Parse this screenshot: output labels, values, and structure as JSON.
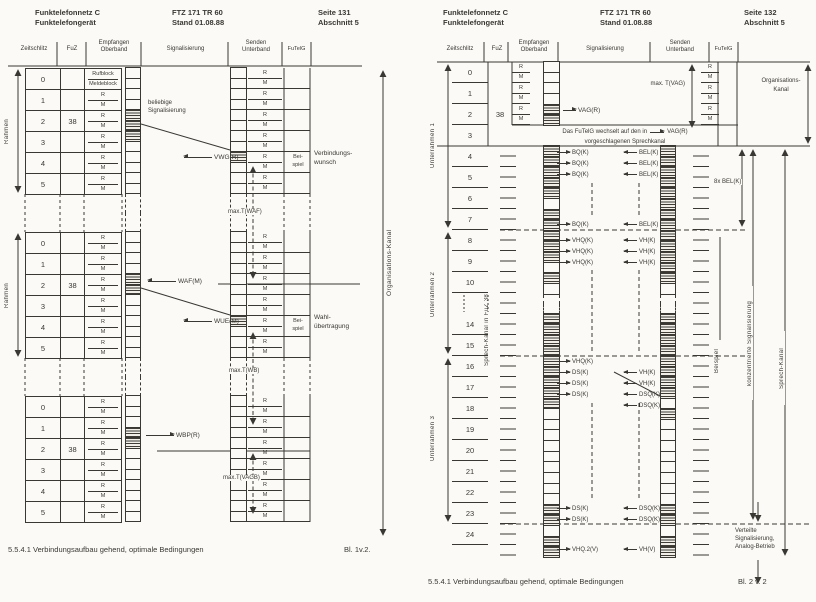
{
  "colors": {
    "ink": "#3a3833",
    "paper": "#fbfaf6"
  },
  "left": {
    "header": {
      "product1": "Funktelefonnetz C",
      "product2": "Funktelefongerät",
      "doc1": "FTZ 171 TR 60",
      "doc2": "Stand 01.08.88",
      "page1": "Seite 131",
      "page2": "Abschnitt 5"
    },
    "columns": {
      "zeitschlitz": "Zeitschlitz",
      "fuz": "FuZ",
      "empfangen1": "Empfangen",
      "empfangen2": "Oberband",
      "signalisierung": "Signalisierung",
      "senden1": "Senden",
      "senden2": "Unterband",
      "futelg": "FuTelG"
    },
    "rahmen_label": "Rahmen",
    "gap_strip": [
      "d",
      "d"
    ],
    "send_rm": [
      {
        "r": "R",
        "m": "M"
      },
      {
        "r": "R",
        "m": "M"
      },
      {
        "r": "R",
        "m": "M"
      },
      {
        "r": "R",
        "m": "M"
      },
      {
        "r": "R",
        "m": "M"
      },
      {
        "r": "R",
        "m": "M"
      }
    ],
    "frames": [
      {
        "slots": [
          {
            "n": "0",
            "fuz": "",
            "r": "Rufblock",
            "m": "Meldeblock"
          },
          {
            "n": "1",
            "fuz": "",
            "r": "R",
            "m": "M"
          },
          {
            "n": "2",
            "fuz": "38",
            "r": "R",
            "m": "M"
          },
          {
            "n": "3",
            "fuz": "",
            "r": "R",
            "m": "M"
          },
          {
            "n": "4",
            "fuz": "",
            "r": "R",
            "m": "M"
          },
          {
            "n": "5",
            "fuz": "",
            "r": "R",
            "m": "M"
          }
        ],
        "emp": [
          "w",
          "w",
          "w",
          "w",
          "h",
          "h",
          "h",
          "w",
          "w",
          "w",
          "w",
          "w"
        ],
        "send": [
          "w",
          "w",
          "w",
          "w",
          "w",
          "w",
          "w",
          "w",
          "h",
          "w",
          "w",
          "w"
        ]
      },
      {
        "slots": [
          {
            "n": "0",
            "fuz": "",
            "r": "R",
            "m": "M"
          },
          {
            "n": "1",
            "fuz": "",
            "r": "R",
            "m": "M"
          },
          {
            "n": "2",
            "fuz": "38",
            "r": "R",
            "m": "M"
          },
          {
            "n": "3",
            "fuz": "",
            "r": "R",
            "m": "M"
          },
          {
            "n": "4",
            "fuz": "",
            "r": "R",
            "m": "M"
          },
          {
            "n": "5",
            "fuz": "",
            "r": "R",
            "m": "M"
          }
        ],
        "emp": [
          "w",
          "w",
          "w",
          "w",
          "h",
          "h",
          "w",
          "w",
          "w",
          "w",
          "w",
          "w"
        ],
        "send": [
          "w",
          "w",
          "w",
          "w",
          "w",
          "w",
          "w",
          "w",
          "h",
          "w",
          "w",
          "w"
        ]
      },
      {
        "slots": [
          {
            "n": "0",
            "fuz": "",
            "r": "R",
            "m": "M"
          },
          {
            "n": "1",
            "fuz": "",
            "r": "R",
            "m": "M"
          },
          {
            "n": "2",
            "fuz": "38",
            "r": "R",
            "m": "M"
          },
          {
            "n": "3",
            "fuz": "",
            "r": "R",
            "m": "M"
          },
          {
            "n": "4",
            "fuz": "",
            "r": "R",
            "m": "M"
          },
          {
            "n": "5",
            "fuz": "",
            "r": "R",
            "m": "M"
          }
        ],
        "emp": [
          "w",
          "w",
          "w",
          "h",
          "h",
          "w",
          "w",
          "w",
          "w",
          "w",
          "w",
          "w"
        ],
        "send": [
          "w",
          "w",
          "w",
          "w",
          "w",
          "w",
          "w",
          "w",
          "w",
          "w",
          "w",
          "w"
        ]
      }
    ],
    "sig": {
      "beliebige1": "beliebige",
      "beliebige2": "Signalisierung",
      "vwg": "VWG(R)",
      "max_waf": "max.T(WAF)",
      "waf": "WAF(M)",
      "wue": "WUE(M)",
      "max_wb": "max.T(WB)",
      "wbp": "WBP(R)",
      "max_vagb": "max.T(VAGB)"
    },
    "beispiel1": "Bei-",
    "beispiel2": "spiel",
    "verbindung1": "Verbindungs-",
    "verbindung2": "wunsch",
    "wahl1": "Wahl-",
    "wahl2": "übertragung",
    "org_kanal": "Organisations-Kanal",
    "caption": "5.5.4.1 Verbindungsaufbau gehend, optimale Bedingungen",
    "blatt": "Bl. 1v.2."
  },
  "right": {
    "header": {
      "product1": "Funktelefonnetz C",
      "product2": "Funktelefongerät",
      "doc1": "FTZ 171 TR 60",
      "doc2": "Stand 01.08.88",
      "page1": "Seite 132",
      "page2": "Abschnitt 5"
    },
    "columns": {
      "zeitschlitz": "Zeitschlitz",
      "fuz": "FuZ",
      "empfangen1": "Empfangen",
      "empfangen2": "Oberband",
      "signalisierung": "Signalisierung",
      "senden1": "Senden",
      "senden2": "Unterband",
      "futelg": "FuTelG"
    },
    "unterrahmen": [
      "Unterrahmen 1",
      "Unterrahmen 2",
      "Unterrahmen 3"
    ],
    "sprech_fuz": "Sprech-Kanal in FuZ 38",
    "org_rows": [
      {
        "n": "0",
        "fuz": ""
      },
      {
        "n": "1",
        "fuz": ""
      },
      {
        "n": "2",
        "fuz": "38"
      }
    ],
    "org_rm": [
      {
        "r": "R",
        "m": "M"
      },
      {
        "r": "R",
        "m": "M"
      },
      {
        "r": "R",
        "m": "M"
      }
    ],
    "slot3": {
      "n": "3"
    },
    "speech_rows": [
      {
        "n": "4"
      },
      {
        "n": "5"
      },
      {
        "n": "6"
      },
      {
        "n": "7"
      },
      {
        "n": "8"
      },
      {
        "n": "9"
      },
      {
        "n": "10"
      },
      {
        "n": "",
        "g": "1"
      },
      {
        "n": "14"
      },
      {
        "n": "15"
      },
      {
        "n": "16"
      },
      {
        "n": "17"
      },
      {
        "n": "18"
      },
      {
        "n": "19"
      },
      {
        "n": "20"
      },
      {
        "n": "21"
      },
      {
        "n": "22"
      },
      {
        "n": "23"
      },
      {
        "n": "24"
      }
    ],
    "strip_org": [
      "w",
      "w",
      "w",
      "w",
      "h",
      "h"
    ],
    "strip_emp": [
      "h",
      "h",
      "h",
      "h",
      "h",
      "w",
      "h",
      "h",
      "h",
      "h",
      "h",
      "w",
      "h",
      "w",
      "d",
      "d",
      "h",
      "h",
      "h",
      "h",
      "h",
      "h",
      "h",
      "h",
      "h",
      "w",
      "w",
      "w",
      "w",
      "w",
      "w",
      "w",
      "w",
      "w",
      "h",
      "h",
      "w",
      "h",
      "h"
    ],
    "strip_send": [
      "h",
      "h",
      "h",
      "h",
      "h",
      "h",
      "h",
      "h",
      "h",
      "h",
      "h",
      "h",
      "h",
      "w",
      "d",
      "d",
      "h",
      "h",
      "h",
      "h",
      "h",
      "h",
      "h",
      "h",
      "w",
      "h",
      "w",
      "w",
      "w",
      "w",
      "w",
      "w",
      "w",
      "w",
      "h",
      "h",
      "w",
      "h",
      "h"
    ],
    "sig": {
      "vag": "VAG(R)",
      "max_t_vag": "max. T(VAG)",
      "bel8": "8x BEL(K)",
      "org1": "Organisations-",
      "org2": "Kanal",
      "note1": "Das FuTelG wechselt auf den in",
      "note_vag": "VAG(R)",
      "note2": "vorgeschlagenen Sprechkanal"
    },
    "g1": [
      {
        "tx": "BQ(K)",
        "rx": "BEL(K)"
      },
      {
        "tx": "BQ(K)",
        "rx": "BEL(K)"
      },
      {
        "tx": "BQ(K)",
        "rx": "BEL(K)"
      }
    ],
    "g2": [
      {
        "tx": "BQ(K)",
        "rx": "BEL(K)"
      }
    ],
    "g3": [
      {
        "tx": "VHQ(K)",
        "rx": "VH(K)"
      },
      {
        "tx": "VHQ(K)",
        "rx": "VH(K)"
      },
      {
        "tx": "VHQ(K)",
        "rx": "VH(K)"
      }
    ],
    "g4a": {
      "tx": "VHQ(K)"
    },
    "g4": [
      {
        "tx": "DS(K)",
        "rx": "VH(K)"
      },
      {
        "tx": "DS(K)",
        "rx": "VH(K)"
      },
      {
        "tx": "DS(K)",
        "rx": "DSQ(K)"
      }
    ],
    "g4b": {
      "rx": "DSQ(K)"
    },
    "g5": [
      {
        "tx": "DS(K)",
        "rx": "DSQ(K)"
      },
      {
        "tx": "DS(K)",
        "rx": "DSQ(K)"
      }
    ],
    "g6": {
      "tx": "VHQ.2(V)",
      "rx": "VH(V)"
    },
    "beispiel": "Beispiel",
    "konz": "konzentrierte Signalisierung",
    "sprech_kanal": "Sprech-Kanal",
    "verteilte1": "Verteilte",
    "verteilte2": "Signalisierung,",
    "verteilte3": "Analog-Betrieb",
    "caption": "5.5.4.1 Verbindungsaufbau gehend, optimale Bedingungen",
    "blatt": "Bl. 2 v. 2"
  }
}
